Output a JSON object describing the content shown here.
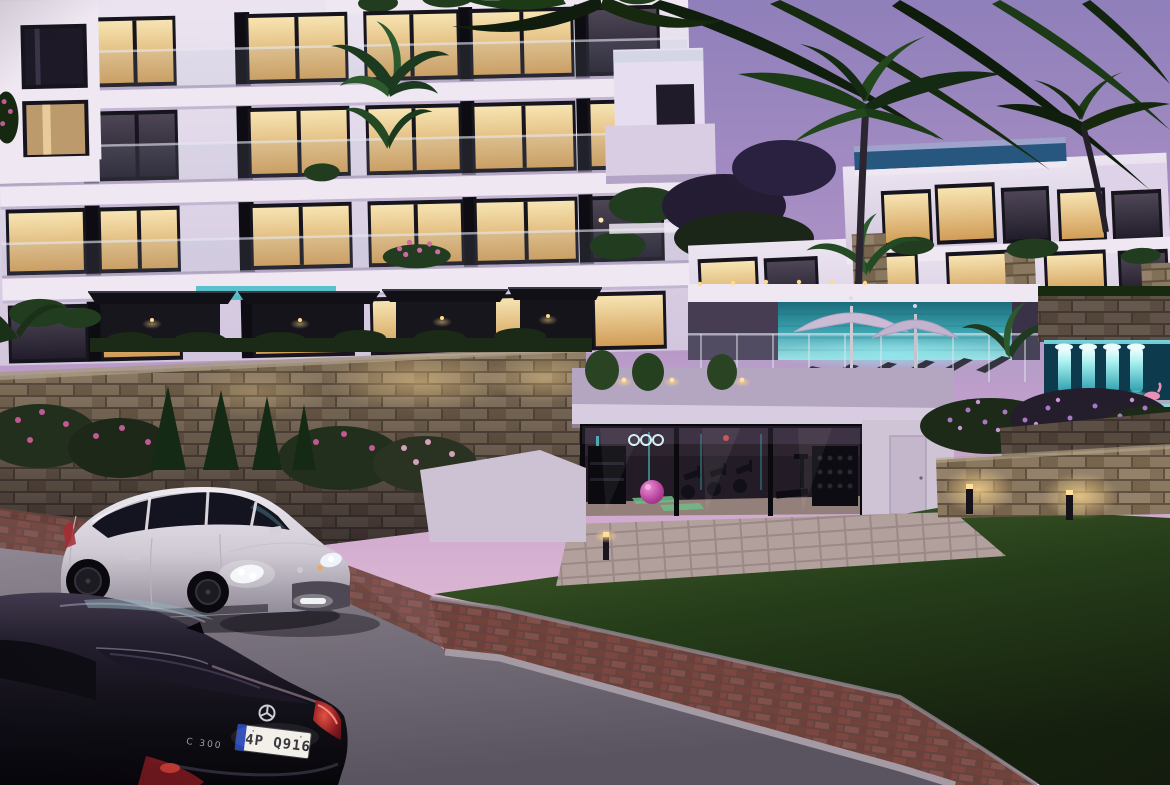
{
  "scene": {
    "description": "Dusk architectural rendering of a modern hillside apartment complex with warm-lit balconies, pool terraces with umbrellas and loungers, a teal-lit water feature, a glass-fronted gym with equipment, stacked-stone walls, a lawn, a brick path, a white SUV and a black sedan parked on the road",
    "time_of_day": "dusk"
  },
  "palette": {
    "sky_top": "#8f7fba",
    "sky_horizon": "#f0d2de",
    "facade_white": "#e9e2ef",
    "warm_window": "#f0cf92",
    "pool_teal": "#5fd8dc",
    "neon_teal": "#53e0e6",
    "stone_tan": "#8a7960",
    "brick_paver": "#7d4740",
    "road_asphalt": "#857e89",
    "grass_green": "#2c421e",
    "umbrella_lavender": "#cbbcd6",
    "exercise_ball_pink": "#c94fae",
    "yoga_mat_green": "#79c98e",
    "taillight_red": "#c0252a",
    "plate_blue": "#2646b4"
  },
  "vehicles": {
    "suv": {
      "color_hex": "#d6d1d9"
    },
    "sedan": {
      "color_hex": "#121016",
      "badge": "C 300",
      "license_plate": "4P Q916"
    }
  }
}
